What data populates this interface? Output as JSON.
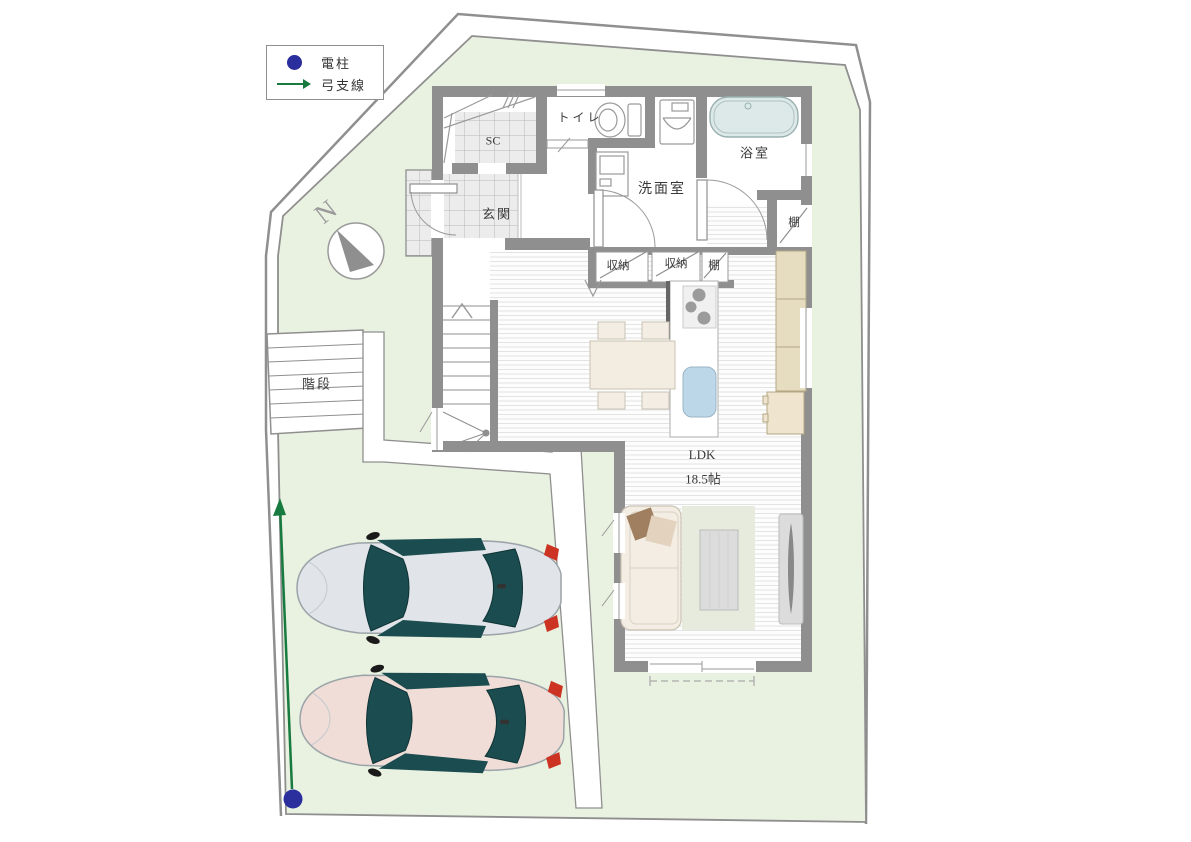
{
  "legend": {
    "pole_label": "電柱",
    "wire_label": "弓支線"
  },
  "compass": {
    "north_label": "N"
  },
  "rooms": {
    "shoe_closet": "SC",
    "toilet": "トイレ",
    "bathroom": "浴室",
    "washroom": "洗面室",
    "entrance": "玄関",
    "storage_left": "収納",
    "storage_right": "収納",
    "shelf_row": "棚",
    "shelf_nook": "棚",
    "outdoor_stairs": "階段",
    "living": "LDK",
    "living_size": "18.5帖"
  },
  "colors": {
    "lot_green": "#e9f1e0",
    "wall_gray": "#8f8f8f",
    "pole_navy": "#2b2f9d",
    "wire_green": "#177a3e",
    "bathtub_blue": "#dce9e8",
    "car_silver": "#e1e5e9",
    "car_pink": "#f0ddd7",
    "glass_teal": "#1b4c4f",
    "tail_red": "#cc3322"
  }
}
